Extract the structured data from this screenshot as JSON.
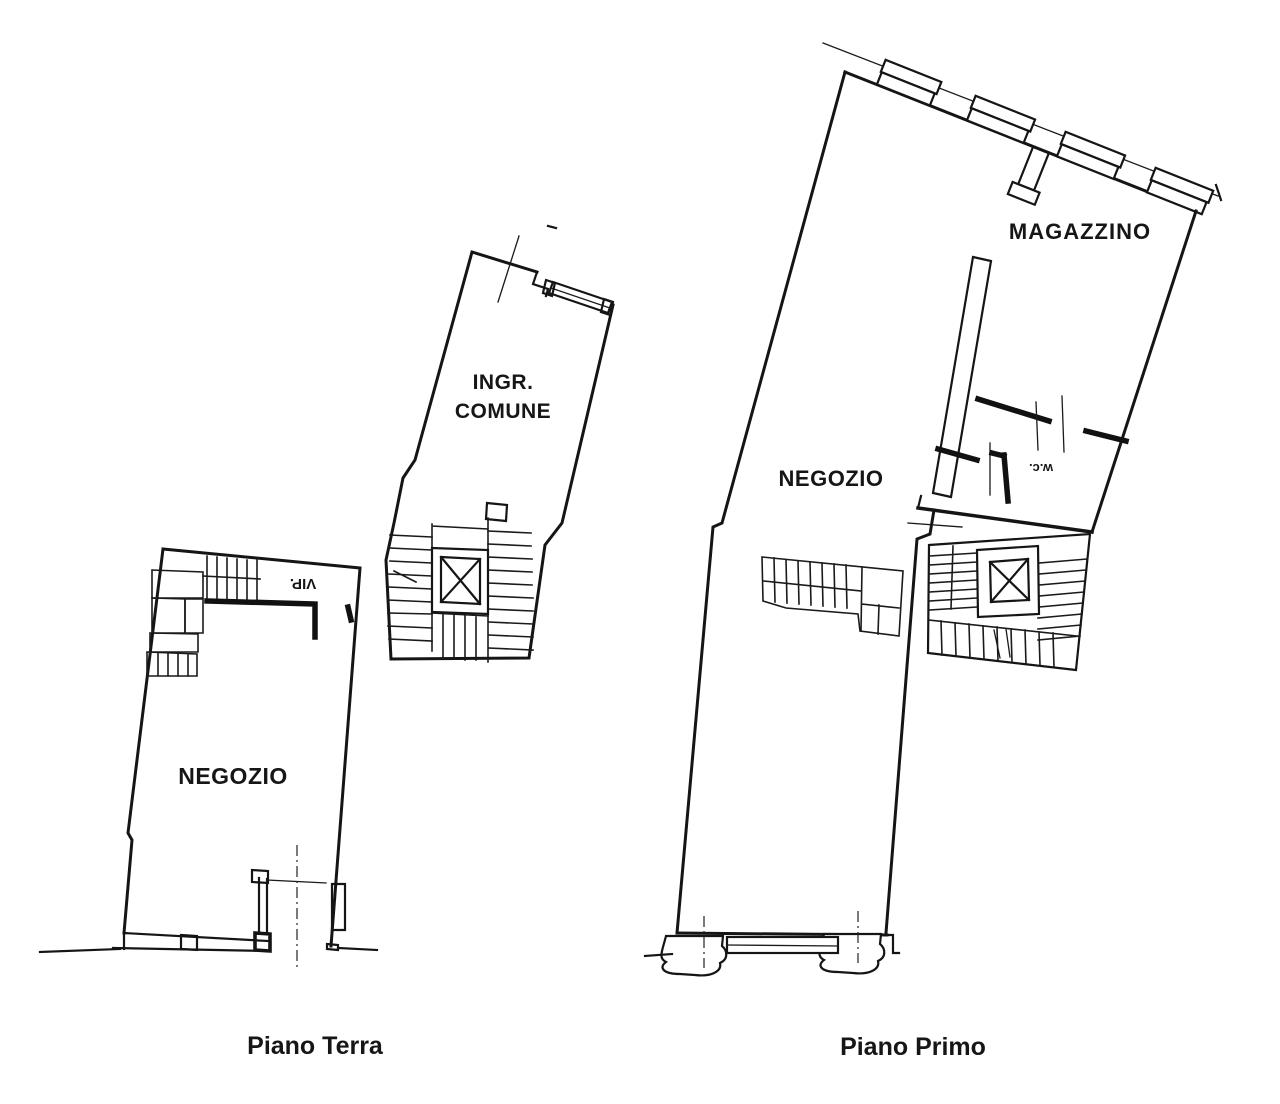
{
  "document": {
    "type": "floor-plan-drawing",
    "background_color": "#ffffff",
    "ink_color": "#151515"
  },
  "ground_floor": {
    "caption": "Piano Terra",
    "shop_label": "NEGOZIO",
    "entrance_label_line1": "INGR.",
    "entrance_label_line2": "COMUNE",
    "stair_annotation_rotated": "VIP."
  },
  "first_floor": {
    "caption": "Piano Primo",
    "shop_label": "NEGOZIO",
    "warehouse_label": "MAGAZZINO",
    "wc_label_rotated": "w.c."
  }
}
